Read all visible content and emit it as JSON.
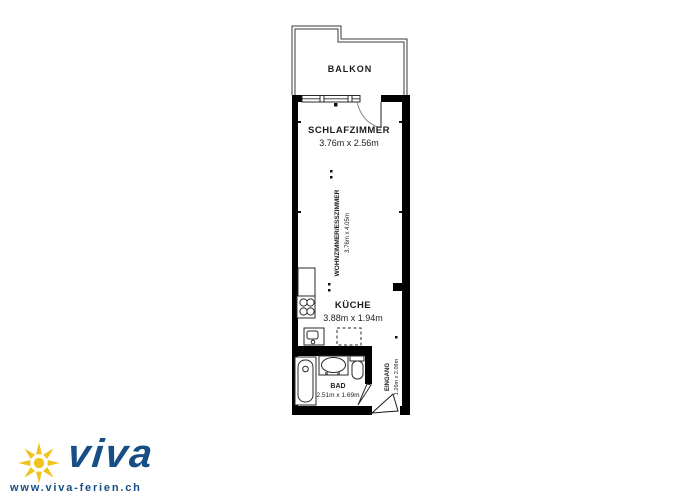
{
  "plan": {
    "rooms": {
      "balkon": {
        "name": "BALKON",
        "size": ""
      },
      "schlafzimmer": {
        "name": "SCHLAFZIMMER",
        "size": "3.76m x 2.56m"
      },
      "wohnzimmer": {
        "name": "WOHNZIMMER/ESSZIMMER",
        "size": "3.76m x 4.05m"
      },
      "kueche": {
        "name": "KÜCHE",
        "size": "3.88m x 1.94m"
      },
      "bad": {
        "name": "BAD",
        "size": "2.51m x 1.69m"
      },
      "eingang": {
        "name": "EINGANG",
        "size": "1.26m x 2.09m"
      }
    }
  },
  "branding": {
    "logo_text": "viva",
    "website": "www.viva-ferien.ch"
  },
  "colors": {
    "wall_black": "#000000",
    "line_gray": "#3a3a3a",
    "brand_blue": "#174e86",
    "brand_yellow": "#f0c31e"
  }
}
